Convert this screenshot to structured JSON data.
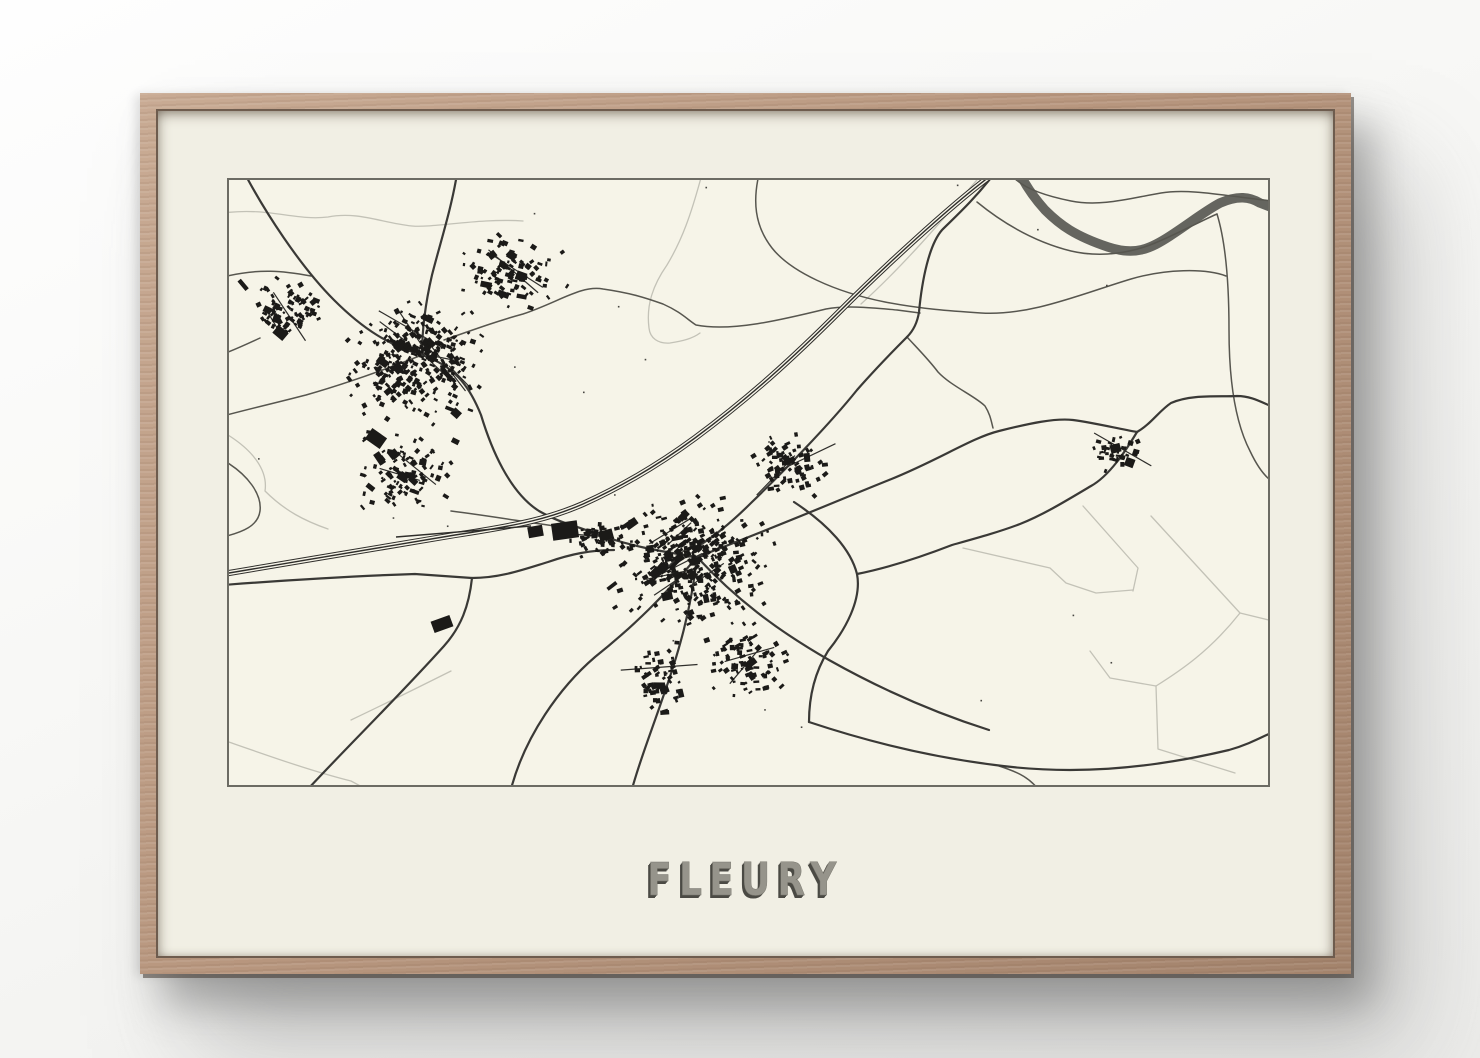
{
  "poster": {
    "title": "FLEURY"
  },
  "palette": {
    "frame_wood": "#b8977f",
    "frame_wood_light": "#c9ab94",
    "frame_wood_dark": "#a3836c",
    "frame_lip": "#6e5c4e",
    "mat": "#f1efe4",
    "map_bg": "#f6f4e8",
    "map_border": "#6c6b63",
    "road_dark": "#3a3936",
    "road_medium": "#57564f",
    "road_light": "#c3c2b7",
    "rail_ink": "#2e2d2a",
    "river": "#65655f",
    "building": "#1b1a18",
    "title_fill": "#96948b",
    "title_shadow": "#4b4a44"
  },
  "map": {
    "railway": "M -6,394 C 70,381 162,366 226,355 C 292,345 322,338 354,324 C 396,305 432,283 466,258 C 520,218 562,180 612,130 C 652,90 722,25 764,-6",
    "railway_siding": "M 167,357 L 302,346",
    "river": "M 791,-6 C 798,8 807,20 816,30 C 831,45 846,56 879,67 C 906,76 921,69 941,56 C 961,43 976,31 991,23 C 1009,15 1021,17 1031,23 L 1044,28",
    "roads_dark": [
      "M 16,-6 C 35,30 70,85 105,120 C 135,150 160,165 193,175 C 225,186 240,205 252,235 C 262,268 280,312 310,331 C 333,344 345,345 362,352 C 402,367 436,372 468,377",
      "M 228,-6 C 222,30 212,60 203,95 C 196,125 193,150 193,175",
      "M 765,-6 C 745,20 725,38 713,50 C 700,65 693,100 690,132 C 688,145 683,152 678,157",
      "M 678,157 C 660,175 642,194 628,210 C 600,245 552,294 523,322 C 505,340 486,356 468,367",
      "M 468,377 C 540,350 610,320 660,300 C 710,280 742,258 770,251 C 802,243 826,238 844,240 C 866,243 886,248 908,252",
      "M 908,252 C 922,244 930,231 942,223 C 962,214 990,217 1008,216 C 1022,216 1032,222 1044,227",
      "M 908,252 C 896,272 880,296 862,306 C 840,319 816,334 791,344 C 770,352 748,358 723,365 C 692,377 658,388 628,394",
      "M 565,322 C 600,345 622,370 628,394 C 633,420 616,450 599,471 C 586,492 580,515 580,542",
      "M 468,377 C 506,418 546,449 600,480 C 648,507 700,531 760,550",
      "M 468,377 C 462,430 450,472 433,520 C 421,555 411,580 403,609",
      "M 468,377 C 436,415 406,445 366,477 C 331,507 296,556 282,609",
      "M 79,609 C 120,565 170,516 215,466 C 232,447 240,426 243,398",
      "M -6,405 C 60,400 122,396 186,394 L 243,398 C 271,398 293,390 319,382 C 342,374 362,370 385,370",
      "M 580,542 C 640,562 702,577 766,585 C 840,595 916,590 1000,570 C 1018,565 1031,558 1044,552"
    ],
    "roads_medium": [
      "M -6,97 C 30,88 55,91 82,96",
      "M 215,160 C 252,147 272,140 294,134 C 330,122 352,105 374,109 C 402,113 417,118 434,124 C 452,132 459,140 467,145 C 502,152 552,140 597,129 C 618,125 645,128 668,130 L 691,133",
      "M 530,-6 C 524,20 525,45 543,68 C 562,92 606,112 656,122 C 692,129 722,131 752,133 C 802,136 852,114 902,99 C 936,89 976,88 997,96",
      "M 678,157 C 690,170 700,180 709,192 C 722,206 746,216 756,226 C 761,234 762,240 764,248",
      "M 193,175 C 150,192 112,205 77,215 C 46,223 20,229 -6,236",
      "M -6,280 C 20,295 33,315 31,331 C 29,346 14,352 -6,357",
      "M 31,158 C 16,165 5,170 -6,174",
      "M 782,-6 C 790,6 812,15 842,21 C 872,27 902,18 932,13 C 962,8 1002,17 1044,21",
      "M 748,22 C 770,40 802,61 842,71 C 872,78 902,73 926,63 C 950,53 976,39 988,34",
      "M 988,34 C 996,60 1000,100 1000,150 C 1000,200 1006,242 1021,271 C 1029,288 1036,297 1044,302",
      "M 770,586 C 792,593 801,599 809,609",
      "M 222,331 C 262,336 302,343 326,346"
    ],
    "roads_light": [
      "M -6,33 C 40,27 66,41 99,37 C 129,31 153,43 183,46 C 205,48 250,38 294,41",
      "M 473,-6 C 462,35 453,60 438,85 C 424,105 417,125 420,148 C 421,158 429,164 441,163 C 453,161 463,159 471,153",
      "M 753,-6 C 712,42 672,88 632,124",
      "M -6,252 C 25,270 39,291 36,311 C 56,331 76,341 99,349",
      "M -6,560 C 40,576 82,591 122,601 L 137,609",
      "M 122,540 C 162,521 192,506 222,491",
      "M 854,326 L 909,388 L 904,411",
      "M 922,336 L 1011,433 L 1044,441",
      "M 734,368 L 821,388 L 837,403 L 867,413 L 904,410",
      "M 861,471 L 881,498 L 927,506",
      "M 927,506 L 929,569 L 1006,593",
      "M 927,506 C 951,491 981,471 1011,433"
    ],
    "landmarks": [
      {
        "x": 45,
        "y": 148,
        "w": 13,
        "h": 10,
        "rot": 40
      },
      {
        "x": 138,
        "y": 252,
        "w": 18,
        "h": 13,
        "rot": 35
      },
      {
        "x": 203,
        "y": 438,
        "w": 20,
        "h": 12,
        "rot": -20
      },
      {
        "x": 299,
        "y": 346,
        "w": 15,
        "h": 11,
        "rot": -10
      },
      {
        "x": 323,
        "y": 342,
        "w": 26,
        "h": 17,
        "rot": -8
      },
      {
        "x": 370,
        "y": 350,
        "w": 14,
        "h": 10,
        "rot": -15
      }
    ],
    "clusters": [
      {
        "cx": 185,
        "cy": 180,
        "sx": 70,
        "sy": 62,
        "n": 330,
        "rot": 40
      },
      {
        "cx": 55,
        "cy": 130,
        "sx": 38,
        "sy": 30,
        "n": 85,
        "rot": 40
      },
      {
        "cx": 170,
        "cy": 290,
        "sx": 55,
        "sy": 45,
        "n": 110,
        "rot": 35
      },
      {
        "cx": 280,
        "cy": 90,
        "sx": 55,
        "sy": 40,
        "n": 100,
        "rot": 30
      },
      {
        "cx": 462,
        "cy": 380,
        "sx": 75,
        "sy": 60,
        "n": 360,
        "rot": -25
      },
      {
        "cx": 560,
        "cy": 285,
        "sx": 40,
        "sy": 32,
        "n": 80,
        "rot": -25
      },
      {
        "cx": 520,
        "cy": 480,
        "sx": 45,
        "sy": 38,
        "n": 90,
        "rot": -20
      },
      {
        "cx": 430,
        "cy": 500,
        "sx": 30,
        "sy": 40,
        "n": 60,
        "rot": -20
      },
      {
        "cx": 372,
        "cy": 358,
        "sx": 40,
        "sy": 22,
        "n": 55,
        "rot": -15
      },
      {
        "cx": 890,
        "cy": 272,
        "sx": 25,
        "sy": 18,
        "n": 38,
        "rot": 0
      }
    ],
    "scatter_count": 22,
    "seed": 42,
    "viewbox": "0 0 1039 605"
  }
}
